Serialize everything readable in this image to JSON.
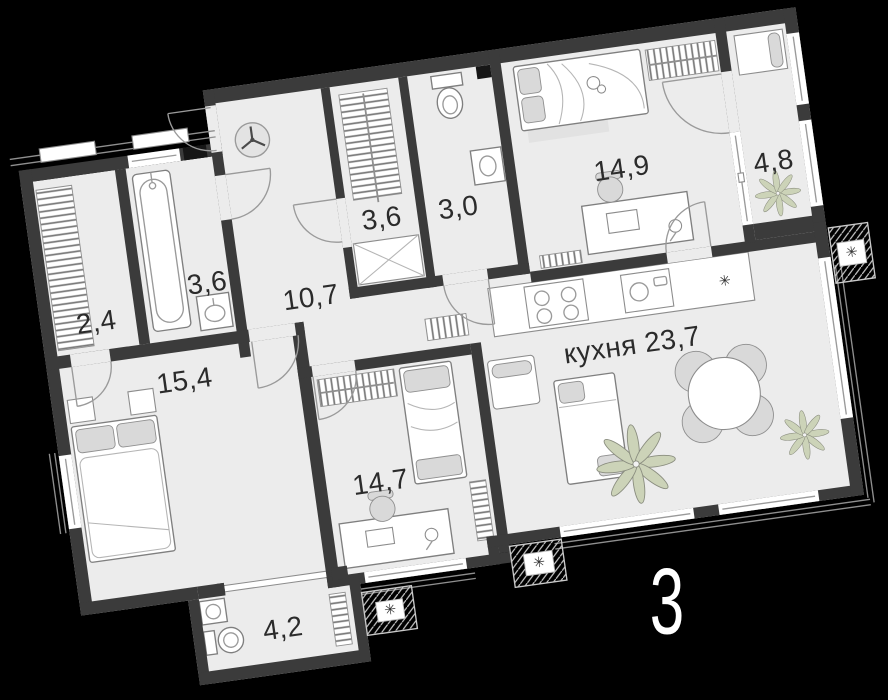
{
  "plan": {
    "plan_number": "3",
    "rooms": [
      {
        "name": "wardrobe",
        "label": "2,4"
      },
      {
        "name": "bathroom",
        "label": "3,6"
      },
      {
        "name": "hallway",
        "label": "10,7"
      },
      {
        "name": "closet",
        "label": "3,6"
      },
      {
        "name": "wc",
        "label": "3,0"
      },
      {
        "name": "bedroom",
        "label": "14,9"
      },
      {
        "name": "balcony",
        "label": "4,8"
      },
      {
        "name": "bedroom-master",
        "label": "15,4"
      },
      {
        "name": "bedroom-kids",
        "label": "14,7"
      },
      {
        "name": "kitchen-living",
        "label": "кухня 23,7"
      },
      {
        "name": "bathroom-small",
        "label": "4,2"
      }
    ],
    "symbols": {
      "fridge_symbol": "✳",
      "ac_symbol": "✳"
    },
    "colors": {
      "background": "#000000",
      "floor": "#ececec",
      "walls": "#3b3b3b",
      "plant": "#ccd3b8",
      "label_text": "#2b2b2b",
      "plan_number": "#ffffff"
    }
  }
}
